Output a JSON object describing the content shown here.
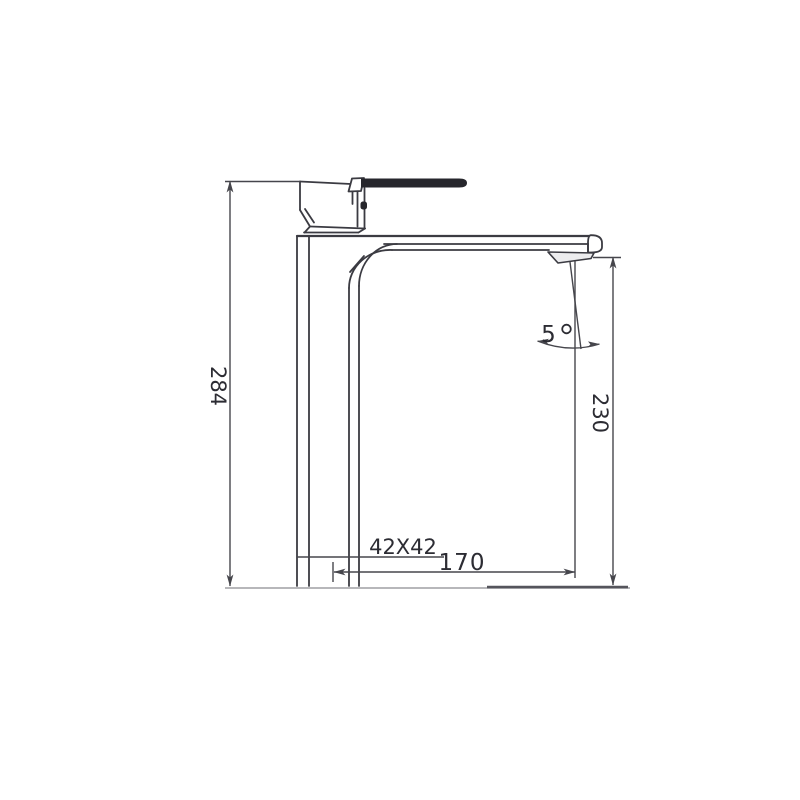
{
  "drawing": {
    "labels": {
      "overall_height": "284",
      "outlet_height": "230",
      "reach": "170",
      "body_section": "42X42",
      "stream_angle": "5",
      "degree": "°"
    },
    "colors": {
      "line": "#3b3b42",
      "dim": "#46464c",
      "lever": "#26262c",
      "baseline_light": "#b7b7ba",
      "baseline_dark": "#55555c",
      "wedge_fill": "#ececee",
      "background": "#ffffff"
    }
  }
}
